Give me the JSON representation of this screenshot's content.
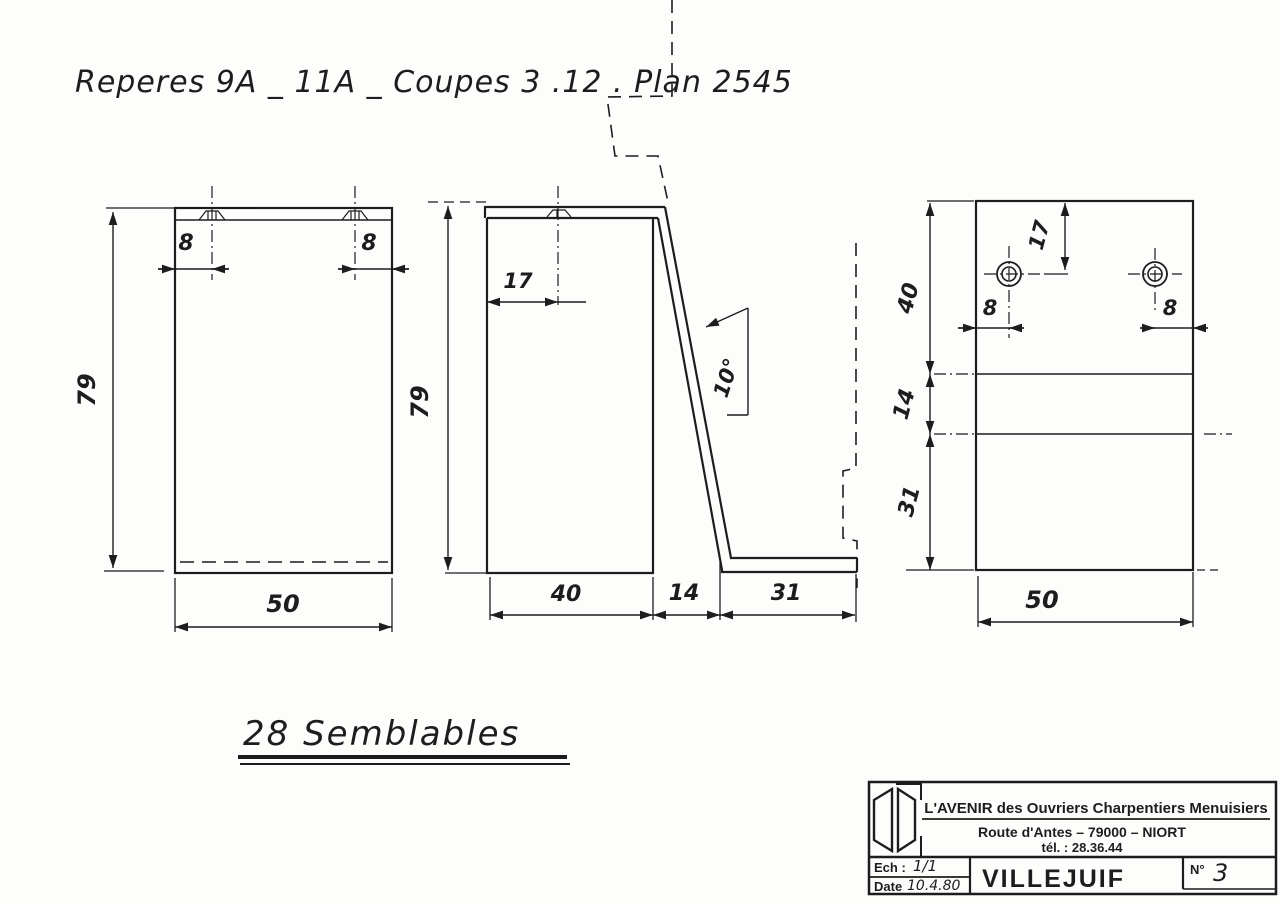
{
  "title": "Reperes 9A _ 11A _ Coupes 3 .12 . Plan 2545",
  "note": "28 Semblables",
  "front": {
    "height": "79",
    "width": "50",
    "hole_left": "8",
    "hole_right": "8"
  },
  "side": {
    "height": "79",
    "hole": "17",
    "angle": "10°",
    "d40": "40",
    "d14": "14",
    "d31": "31"
  },
  "rear": {
    "b40": "40",
    "b14": "14",
    "b31": "31",
    "hole_top": "17",
    "hole_left": "8",
    "hole_right": "8",
    "width": "50"
  },
  "block": {
    "company": "L'AVENIR  des Ouvriers Charpentiers Menuisiers",
    "address": "Route d'Antes  –  79000  –  NIORT",
    "phone": "tél. : 28.36.44",
    "scale_label": "Ech :",
    "scale": "1/1",
    "date_label": "Date",
    "date": "10.4.80",
    "project": "VILLEJUIF",
    "num_label": "N°",
    "num": "3"
  }
}
